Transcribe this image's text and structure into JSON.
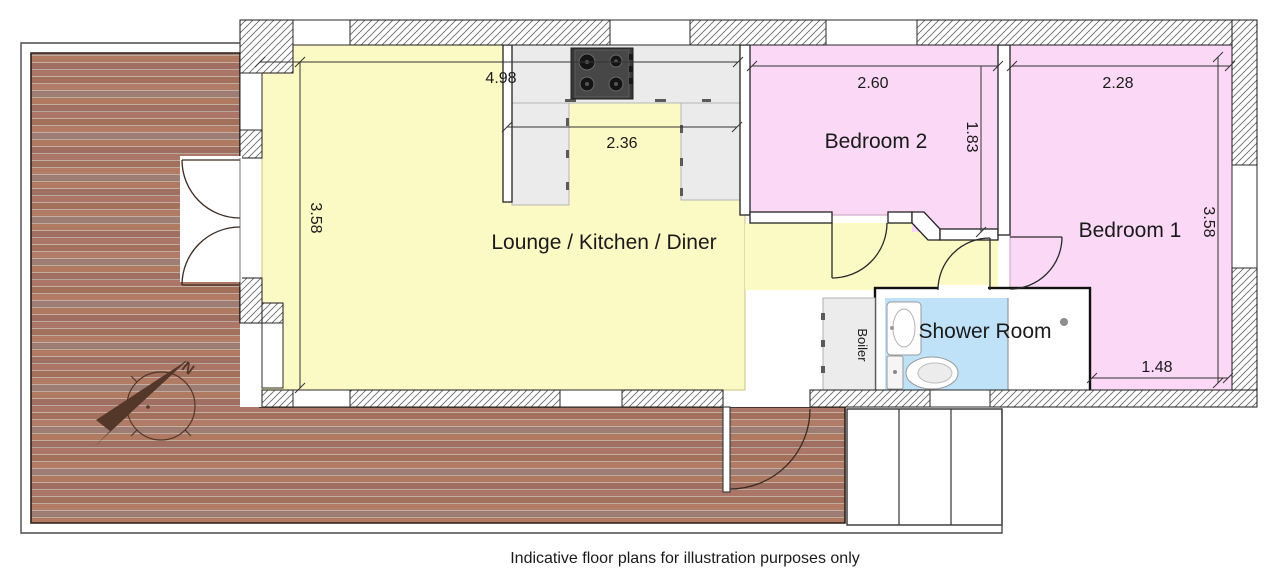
{
  "caption": "Indicative floor plans for illustration purposes only",
  "compass": {
    "north_label": "N"
  },
  "rooms": {
    "lounge": {
      "label": "Lounge / Kitchen / Diner"
    },
    "bedroom2": {
      "label": "Bedroom 2"
    },
    "bedroom1": {
      "label": "Bedroom 1"
    },
    "shower": {
      "label": "Shower Room"
    },
    "boiler": {
      "label": "Boiler"
    }
  },
  "dimensions_m": {
    "lounge_width": "4.98",
    "kitchen_recess_width": "2.36",
    "lounge_depth": "3.58",
    "bedroom2_width": "2.60",
    "bedroom2_depth": "1.83",
    "bedroom1_width": "2.28",
    "bedroom1_depth": "3.58",
    "bedroom1_lower_width": "1.48"
  },
  "colors": {
    "lounge_floor": "#fcfac4",
    "bedroom_floor": "#fbd9f6",
    "shower_floor": "#bfe2f8",
    "kitchen_counter": "#ebebeb",
    "brick_paving": "#a7735f",
    "wall_outline": "#1a1a1a"
  }
}
